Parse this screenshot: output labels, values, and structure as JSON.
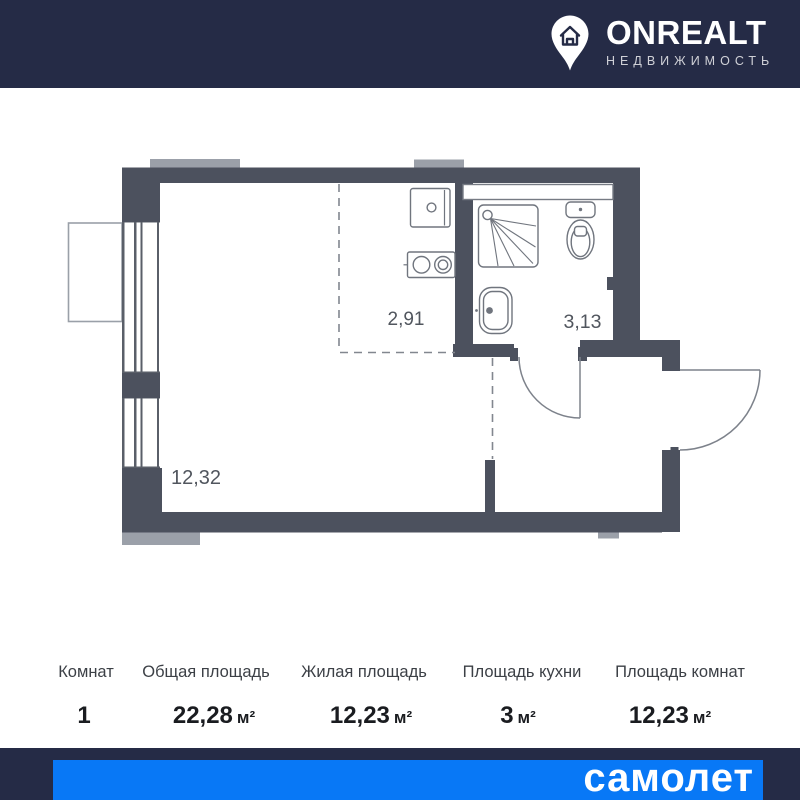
{
  "logo": {
    "title": "ONREALT",
    "subtitle": "НЕДВИЖИМОСТЬ"
  },
  "plan": {
    "rooms": [
      {
        "name": "living-room",
        "area": "12,32"
      },
      {
        "name": "kitchen-zone",
        "area": "2,91"
      },
      {
        "name": "bathroom",
        "area": "3,13"
      }
    ]
  },
  "table": {
    "columns": [
      {
        "label": "Комнат",
        "value": "1",
        "unit": ""
      },
      {
        "label": "Общая площадь",
        "value": "22,28",
        "unit": "м²"
      },
      {
        "label": "Жилая площадь",
        "value": "12,23",
        "unit": "м²"
      },
      {
        "label": "Площадь кухни",
        "value": "3",
        "unit": "м²"
      },
      {
        "label": "Площадь комнат",
        "value": "12,23",
        "unit": "м²"
      }
    ]
  },
  "footer": {
    "brand": "самолет"
  },
  "colors": {
    "navy": "#252b46",
    "brand_blue": "#0878f6",
    "wall": "#4c515e",
    "fixture_line": "#74787f",
    "room_label": "#51565e",
    "light_gray": "#9ba0a9"
  }
}
